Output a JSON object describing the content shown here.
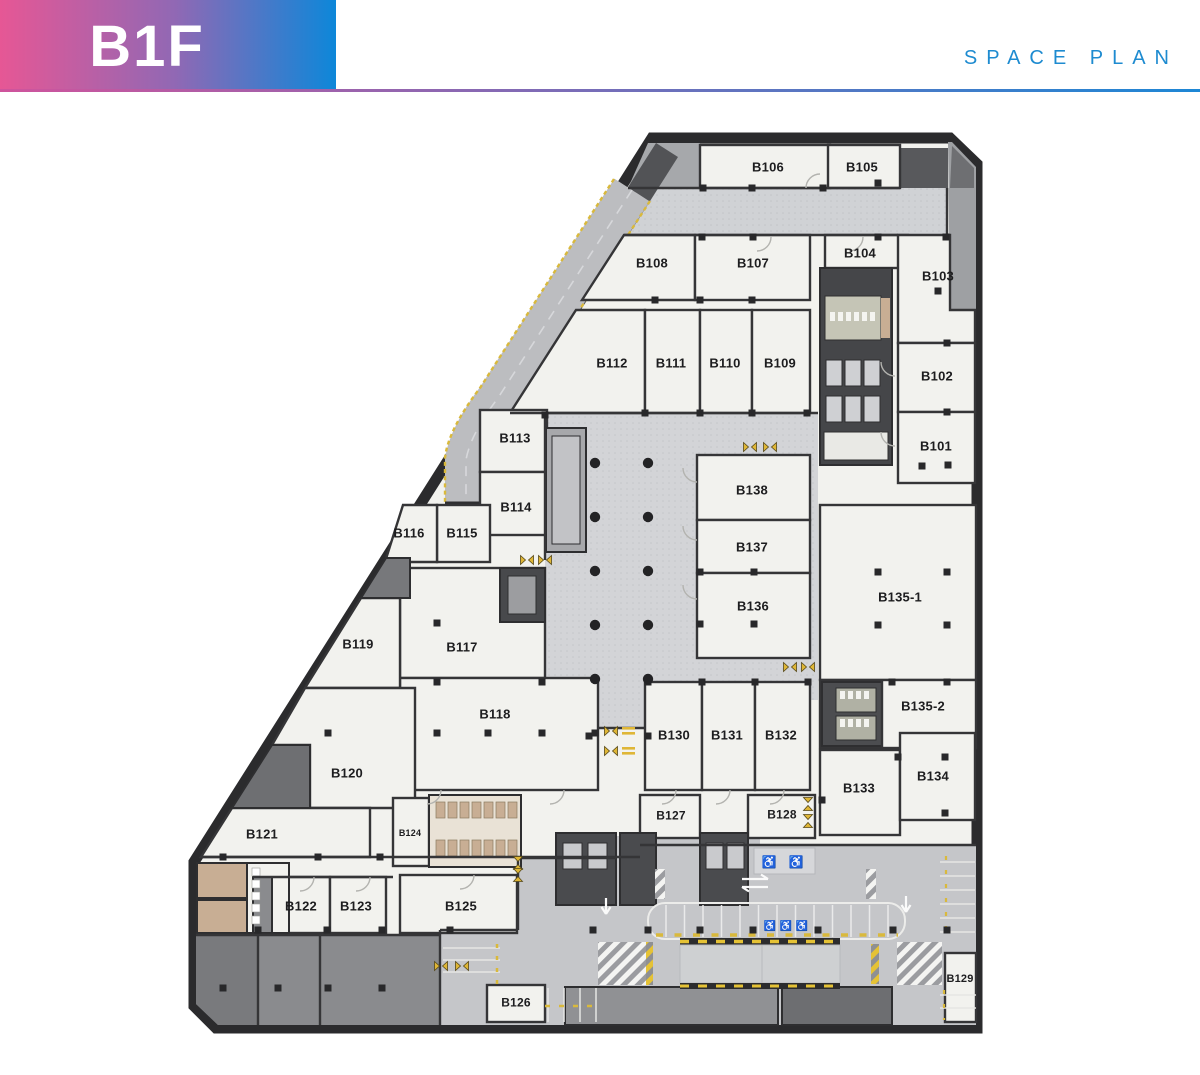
{
  "header": {
    "floor_label": "B1F",
    "plan_label": "SPACE PLAN",
    "colors": {
      "gradient_start": "#e65795",
      "gradient_mid": "#9168b4",
      "gradient_end": "#0d87d9",
      "rule_start": "#cf549c",
      "rule_end": "#1d87d5",
      "accent_text": "#1e8bd0"
    }
  },
  "floor_plan": {
    "colors": {
      "room_fill": "#f2f2ee",
      "wall": "#333335",
      "concourse": "#d3d4d7",
      "corridor": "#cfd1d4",
      "parking": "#c5c6c9",
      "service_dark": "#4a4b4e",
      "service_mid": "#8f9093",
      "ramp_road": "#bcbdc0",
      "safety_yellow": "#e5c235",
      "wood": "#c8ae94"
    },
    "rooms": [
      {
        "id": "B101",
        "x": 936,
        "y": 446
      },
      {
        "id": "B102",
        "x": 937,
        "y": 376
      },
      {
        "id": "B103",
        "x": 938,
        "y": 276
      },
      {
        "id": "B104",
        "x": 860,
        "y": 253
      },
      {
        "id": "B105",
        "x": 862,
        "y": 167
      },
      {
        "id": "B106",
        "x": 768,
        "y": 167
      },
      {
        "id": "B107",
        "x": 753,
        "y": 263
      },
      {
        "id": "B108",
        "x": 652,
        "y": 263
      },
      {
        "id": "B109",
        "x": 780,
        "y": 363
      },
      {
        "id": "B110",
        "x": 725,
        "y": 363
      },
      {
        "id": "B111",
        "x": 671,
        "y": 363
      },
      {
        "id": "B112",
        "x": 612,
        "y": 363
      },
      {
        "id": "B113",
        "x": 515,
        "y": 438
      },
      {
        "id": "B114",
        "x": 516,
        "y": 507
      },
      {
        "id": "B115",
        "x": 462,
        "y": 533
      },
      {
        "id": "B116",
        "x": 409,
        "y": 533
      },
      {
        "id": "B117",
        "x": 462,
        "y": 647
      },
      {
        "id": "B118",
        "x": 495,
        "y": 714
      },
      {
        "id": "B119",
        "x": 358,
        "y": 644
      },
      {
        "id": "B120",
        "x": 347,
        "y": 773
      },
      {
        "id": "B121",
        "x": 262,
        "y": 834
      },
      {
        "id": "B122",
        "x": 301,
        "y": 906
      },
      {
        "id": "B123",
        "x": 356,
        "y": 906
      },
      {
        "id": "B124",
        "x": 410,
        "y": 833,
        "size": 9
      },
      {
        "id": "B125",
        "x": 461,
        "y": 906
      },
      {
        "id": "B126",
        "x": 516,
        "y": 1002,
        "size": 12
      },
      {
        "id": "B127",
        "x": 671,
        "y": 815,
        "size": 12
      },
      {
        "id": "B128",
        "x": 782,
        "y": 814,
        "size": 12
      },
      {
        "id": "B129",
        "x": 960,
        "y": 978,
        "size": 11
      },
      {
        "id": "B130",
        "x": 674,
        "y": 735
      },
      {
        "id": "B131",
        "x": 727,
        "y": 735
      },
      {
        "id": "B132",
        "x": 781,
        "y": 735
      },
      {
        "id": "B133",
        "x": 859,
        "y": 788
      },
      {
        "id": "B134",
        "x": 933,
        "y": 776
      },
      {
        "id": "B135-1",
        "x": 900,
        "y": 597
      },
      {
        "id": "B135-2",
        "x": 923,
        "y": 706
      },
      {
        "id": "B136",
        "x": 753,
        "y": 606
      },
      {
        "id": "B137",
        "x": 752,
        "y": 547
      },
      {
        "id": "B138",
        "x": 752,
        "y": 490
      }
    ]
  }
}
